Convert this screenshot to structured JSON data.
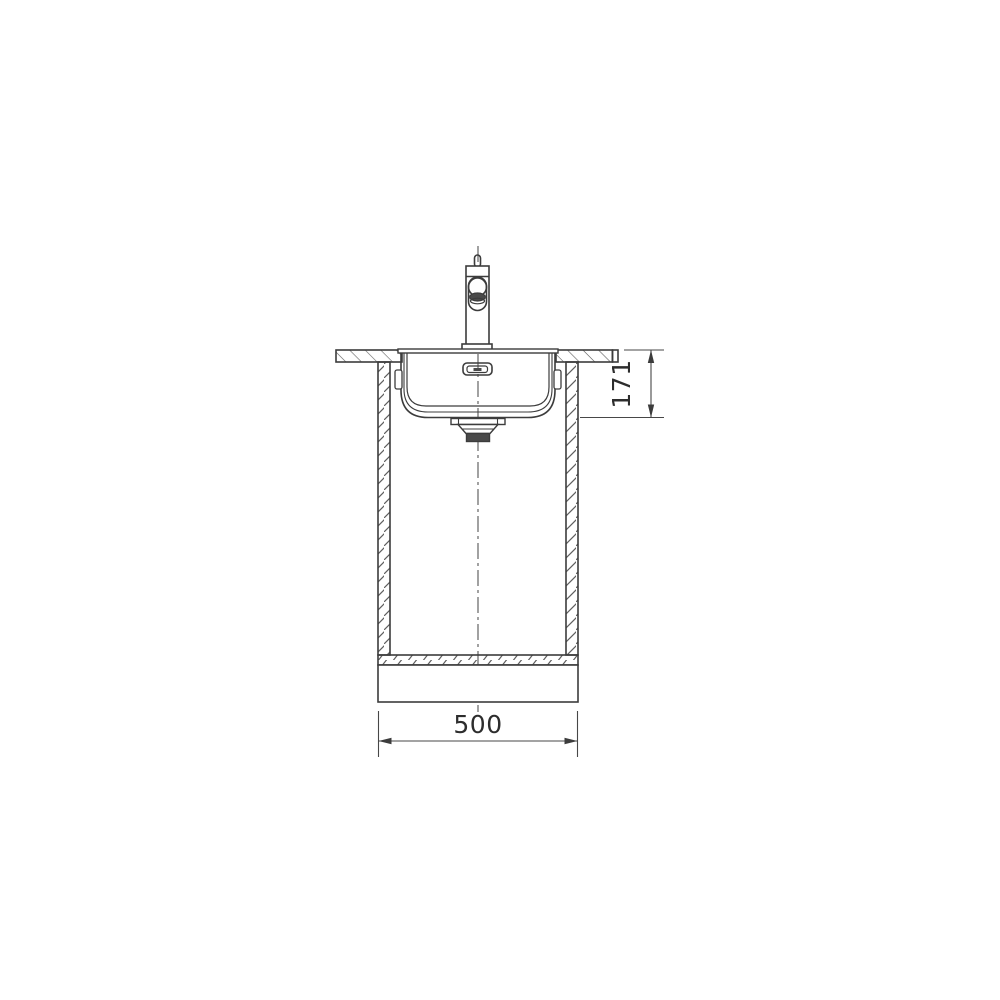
{
  "diagram": {
    "type": "technical-drawing",
    "subject": "kitchen-sink-installation-front-section",
    "background": "#ffffff",
    "line_color": "#3c3c3c",
    "hatch_color": "#5f5f5f",
    "dark_fill_color": "#4a4a4a",
    "dimensions": {
      "cabinet_width": "500",
      "bowl_depth": "171"
    },
    "parts": [
      "faucet",
      "faucet-handle",
      "countertop-left",
      "countertop-right",
      "sink-rim",
      "sink-bowl",
      "overflow-outlet",
      "mounting-clip-left",
      "mounting-clip-right",
      "drain-assembly",
      "cabinet-left-wall",
      "cabinet-right-wall",
      "cabinet-bottom-panel",
      "plinth",
      "vertical-centerline",
      "width-dimension",
      "depth-dimension"
    ]
  }
}
